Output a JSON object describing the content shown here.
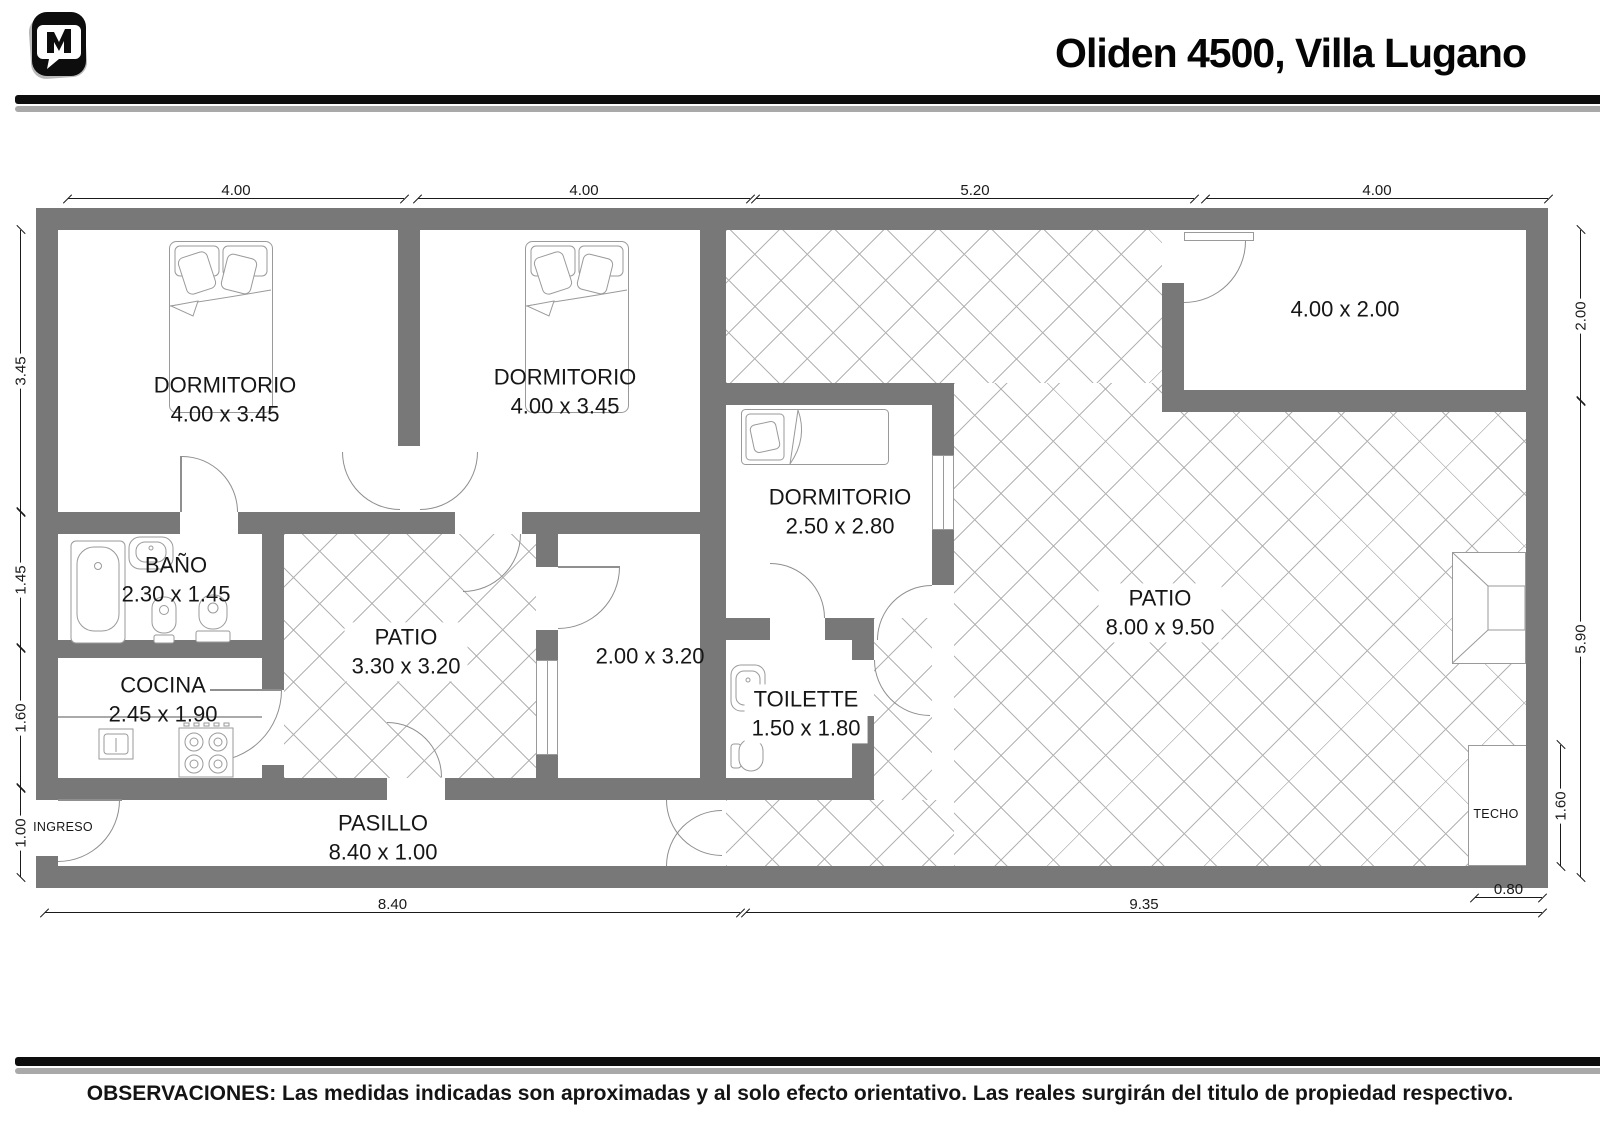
{
  "header": {
    "title": "Oliden 4500, Villa Lugano",
    "logo_name": "m-bubble-logo"
  },
  "plan": {
    "rooms": {
      "dormitorio1": {
        "label": "DORMITORIO",
        "dims": "4.00 x 3.45"
      },
      "dormitorio2": {
        "label": "DORMITORIO",
        "dims": "4.00 x 3.45"
      },
      "dormitorio3": {
        "label": "DORMITORIO",
        "dims": "2.50 x 2.80"
      },
      "bano": {
        "label": "BAÑO",
        "dims": "2.30 x 1.45"
      },
      "cocina": {
        "label": "COCINA",
        "dims": "2.45 x 1.90"
      },
      "patio_interno": {
        "label": "PATIO",
        "dims": "3.30 x 3.20"
      },
      "ambiente": {
        "dims": "2.00 x 3.20"
      },
      "toilette": {
        "label": "TOILETTE",
        "dims": "1.50 x 1.80"
      },
      "patio": {
        "label": "PATIO",
        "dims": "8.00 x 9.50"
      },
      "pasillo": {
        "label": "PASILLO",
        "dims": "8.40 x 1.00"
      },
      "deposito": {
        "dims": "4.00 x 2.00"
      },
      "techo": {
        "label": "TECHO"
      },
      "ingreso": {
        "label": "INGRESO"
      }
    },
    "dims": {
      "top": [
        "4.00",
        "4.00",
        "5.20",
        "4.00"
      ],
      "left": [
        "3.45",
        "1.45",
        "1.60",
        "1.00"
      ],
      "right": [
        "2.00",
        "5.90",
        "1.60"
      ],
      "bottom": [
        "8.40",
        "9.35",
        "0.80"
      ]
    },
    "colors": {
      "wall": "#787878",
      "hatch_line": "#b3b3b3",
      "fixture_line": "#9a9a9a"
    }
  },
  "footer": {
    "observations": "OBSERVACIONES: Las medidas indicadas son aproximadas y al solo efecto orientativo. Las reales surgirán del titulo de propiedad respectivo."
  }
}
